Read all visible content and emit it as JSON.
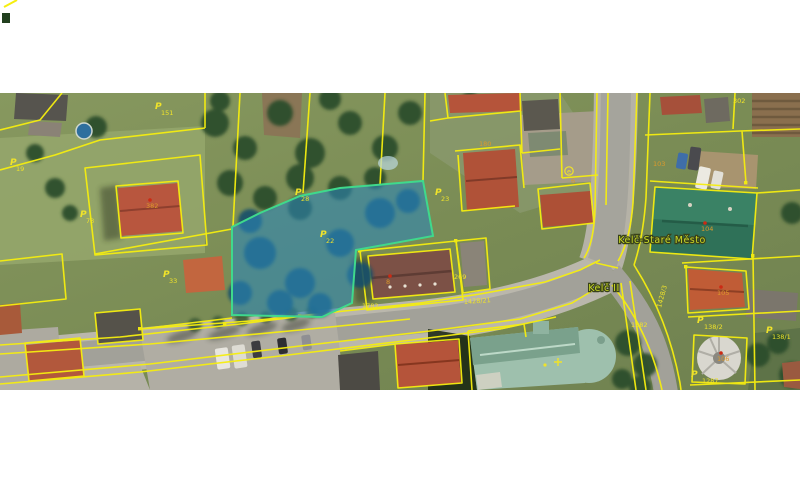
{
  "map_view": {
    "region_labels": [
      {
        "id": "cadastral-area-stare-mesto",
        "text": "Kelč-Staré Město",
        "x": 662,
        "y": 150,
        "size": 9.5
      },
      {
        "id": "cadastral-area-kelc-ii",
        "text": "Kelč II",
        "x": 604,
        "y": 198,
        "size": 9.5
      }
    ],
    "parcel_labels": [
      {
        "text": "151",
        "x": 161,
        "y": 22,
        "flag": {
          "x": 155,
          "y": 16
        }
      },
      {
        "text": "19",
        "x": 16,
        "y": 78,
        "flag": {
          "x": 10,
          "y": 72
        }
      },
      {
        "text": "73",
        "x": 86,
        "y": 130,
        "flag": {
          "x": 80,
          "y": 124
        }
      },
      {
        "text": "33",
        "x": 169,
        "y": 190,
        "flag": {
          "x": 163,
          "y": 184
        }
      },
      {
        "text": "28",
        "x": 301,
        "y": 108,
        "flag": {
          "x": 295,
          "y": 102
        }
      },
      {
        "text": "22",
        "x": 326,
        "y": 150,
        "flag": {
          "x": 320,
          "y": 144
        }
      },
      {
        "text": "23",
        "x": 441,
        "y": 108,
        "flag": {
          "x": 435,
          "y": 102
        }
      },
      {
        "text": "138/2",
        "x": 704,
        "y": 236,
        "flag": {
          "x": 697,
          "y": 230
        }
      },
      {
        "text": "138/1",
        "x": 772,
        "y": 246,
        "flag": {
          "x": 766,
          "y": 240
        }
      },
      {
        "text": "1287",
        "x": 702,
        "y": 290,
        "flag": {
          "x": 691,
          "y": 284
        }
      },
      {
        "text": "1382",
        "x": 631,
        "y": 234
      },
      {
        "text": "1782",
        "x": 362,
        "y": 215
      },
      {
        "text": "269",
        "x": 454,
        "y": 186
      },
      {
        "text": "302",
        "x": 733,
        "y": 10
      }
    ],
    "building_labels": [
      {
        "text": "382",
        "x": 146,
        "y": 115,
        "dot": true
      },
      {
        "text": "8",
        "x": 386,
        "y": 191,
        "dot": true
      },
      {
        "text": "180",
        "x": 479,
        "y": 53,
        "dot": false
      },
      {
        "text": "104",
        "x": 701,
        "y": 138,
        "dot": true
      },
      {
        "text": "103",
        "x": 653,
        "y": 73,
        "dot": false
      },
      {
        "text": "105",
        "x": 717,
        "y": 202,
        "dot": true
      },
      {
        "text": "106",
        "x": 717,
        "y": 268,
        "dot": true
      },
      {
        "text": "6",
        "x": 571,
        "y": 90,
        "dot": false
      }
    ],
    "road_labels": [
      {
        "text": "1428/21",
        "x": 464,
        "y": 211,
        "rotate": -4
      },
      {
        "text": "1428/3",
        "x": 661,
        "y": 215,
        "rotate": -75
      }
    ],
    "symbols": [
      {
        "name": "circled-e-symbol",
        "x": 569,
        "y": 78
      },
      {
        "name": "church-cross-symbol",
        "x": 558,
        "y": 269
      }
    ],
    "selected_parcel": {
      "label": "22",
      "fill": "#2b87b8",
      "fill_opacity": 0.58,
      "stroke": "#3fd98c"
    },
    "colors": {
      "cadastral_line": "#f6ee0f",
      "parcel_text": "#f0e32a",
      "building_text": "#dd9a2b",
      "region_text": "#c9d827",
      "region_halo": "#39421a",
      "definition_dot": "#cc2a14"
    }
  }
}
